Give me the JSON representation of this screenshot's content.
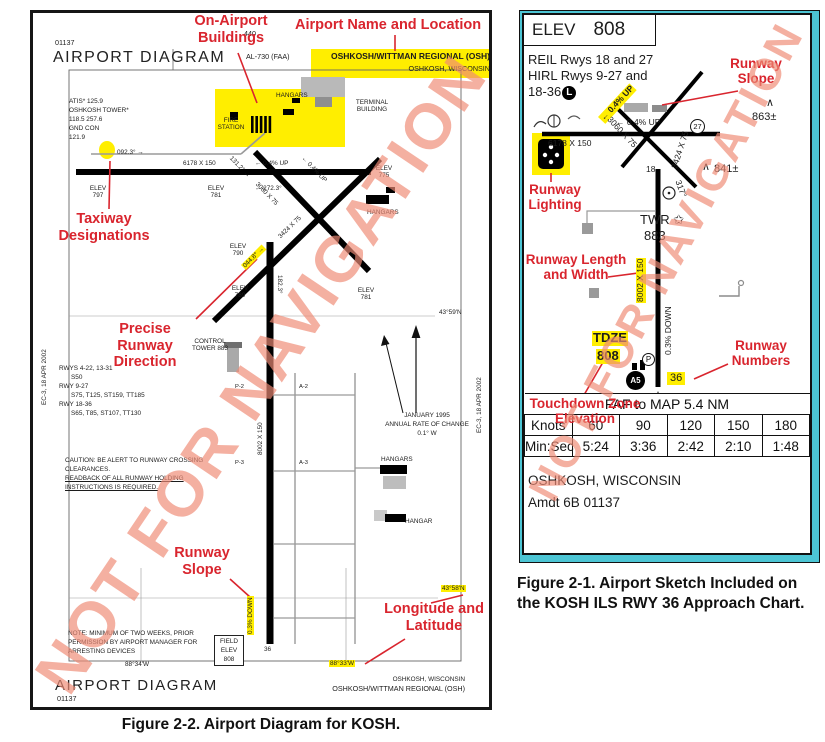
{
  "colors": {
    "callout_red": "#d9252e",
    "highlight_yellow": "#ffee00",
    "frame_cyan": "#4cc5d4",
    "watermark_salmon": "#ef8b76"
  },
  "watermark": "NOT FOR NAVIGATION",
  "fig22": {
    "caption": "Figure 2-2. Airport Diagram for KOSH.",
    "margin_note": "EC-3, 18 APR 2002",
    "header": {
      "code": "01137",
      "title": "AIRPORT DIAGRAM",
      "al": "AL-730 (FAA)",
      "spot": "440"
    },
    "namebox": {
      "l1": "OSHKOSH/WITTMAN REGIONAL (OSH)",
      "l2": "OSHKOSH, WISCONSIN"
    },
    "callouts": {
      "buildings": "On-Airport Buildings",
      "name": "Airport Name and Location",
      "taxiway": "Taxiway Designations",
      "precise": "Precise Runway Direction",
      "slope": "Runway Slope",
      "lonlat": "Longitude and Latitude"
    },
    "freqs": [
      "ATIS* 125.9",
      "OSHKOSH TOWER*",
      "118.5  257.6",
      "GND CON",
      "121.9"
    ],
    "bldg": {
      "hangars": "HANGARS",
      "fire": "FIRE STATION",
      "terminal": "TERMINAL BUILDING",
      "hangars2": "HANGARS",
      "hangar": "HANGAR",
      "tower": "CONTROL TOWER 883"
    },
    "rwy": {
      "hdg092": "092.3° →",
      "dim927": "6178 X 150",
      "up04": "← 0.4% UP",
      "hdg272": "← 272.3°",
      "hdg131": "131.2° →",
      "dim3060": "3060 X 75",
      "up04b": "← 0.4% UP",
      "dim3424": "3424 X 75",
      "hdg044": "044.8° →",
      "hdg182": "182.3°",
      "dim1836": "8002 X 150",
      "down03": "0.3% DOWN",
      "e797": "ELEV 797",
      "e781a": "ELEV 781",
      "e775": "ELEV 775",
      "e790": "ELEV 790",
      "e789": "ELEV 789",
      "e781b": "ELEV 781",
      "p2": "P-2",
      "a2": "A-2",
      "p3": "P-3",
      "a3": "A-3",
      "r36": "36"
    },
    "data_block": [
      "RWYS 4-22, 13-31",
      "S50",
      "RWY 9-27",
      "S75, T125, ST159, TT185",
      "RWY 18-36",
      "S65, T85, ST107, TT130"
    ],
    "caution": [
      "CAUTION: BE ALERT TO RUNWAY CROSSING",
      "CLEARANCES.",
      "READBACK OF ALL RUNWAY HOLDING",
      "INSTRUCTIONS IS REQUIRED."
    ],
    "note": [
      "NOTE: MINIMUM OF TWO WEEKS, PRIOR",
      "PERMISSION BY AIRPORT MANAGER FOR",
      "ARRESTING DEVICES"
    ],
    "variation": [
      "JANUARY 1995",
      "ANNUAL RATE OF CHANGE",
      "0.1° W"
    ],
    "coords": {
      "lat59": "43°59'N",
      "lat58": "43°58'N",
      "lon34": "88°34'W",
      "lon33": "88°33'W"
    },
    "field_elev": [
      "FIELD",
      "ELEV",
      "808"
    ],
    "footer": {
      "title": "AIRPORT DIAGRAM",
      "code": "01137",
      "city": "OSHKOSH, WISCONSIN",
      "apt": "OSHKOSH/WITTMAN REGIONAL (OSH)"
    }
  },
  "fig21": {
    "caption1": "Figure 2-1. Airport Sketch Included on",
    "caption2": "the KOSH ILS RWY 36 Approach Chart.",
    "elev_label": "ELEV",
    "elev_value": "808",
    "lighting": [
      "REIL Rwys 18 and 27",
      "HIRL Rwys 9-27 and",
      "18-36"
    ],
    "l_circle": "L",
    "callouts": {
      "slope": "Runway Slope",
      "lighting": "Runway Lighting",
      "lw": "Runway Length and Width",
      "numbers": "Runway Numbers",
      "tdz": "Touchdown Zone Elevation"
    },
    "sk": {
      "slope_diag": "← 0.4% UP",
      "slope927": "← 0.4% UP",
      "dim927": "6178 X 150",
      "dim3060": "3060 X 75",
      "dim3424": "3424 X 75",
      "r27": "27",
      "r18": "18",
      "hdg317": "317°",
      "obs863": "863±",
      "obs841": "841±",
      "caret863": "∧",
      "caret841": "∧",
      "twr": "TWR",
      "star": "✩",
      "twr_elev": "883",
      "dim1836": "8002 X 150",
      "down": "0.3% DOWN",
      "tdze": "TDZE",
      "tdze_val": "808",
      "p": "P",
      "a5": "A5",
      "r36": "36",
      "faf1": "359° 5.4 NM",
      "faf2": "from FAF"
    },
    "table": {
      "span": "FAF to MAP  5.4 NM",
      "knots": [
        "Knots",
        "60",
        "90",
        "120",
        "150",
        "180"
      ],
      "minsec": [
        "Min:Sec",
        "5:24",
        "3:36",
        "2:42",
        "2:10",
        "1:48"
      ]
    },
    "footer1": "OSHKOSH, WISCONSIN",
    "footer2": "Amdt 6B  01137"
  }
}
